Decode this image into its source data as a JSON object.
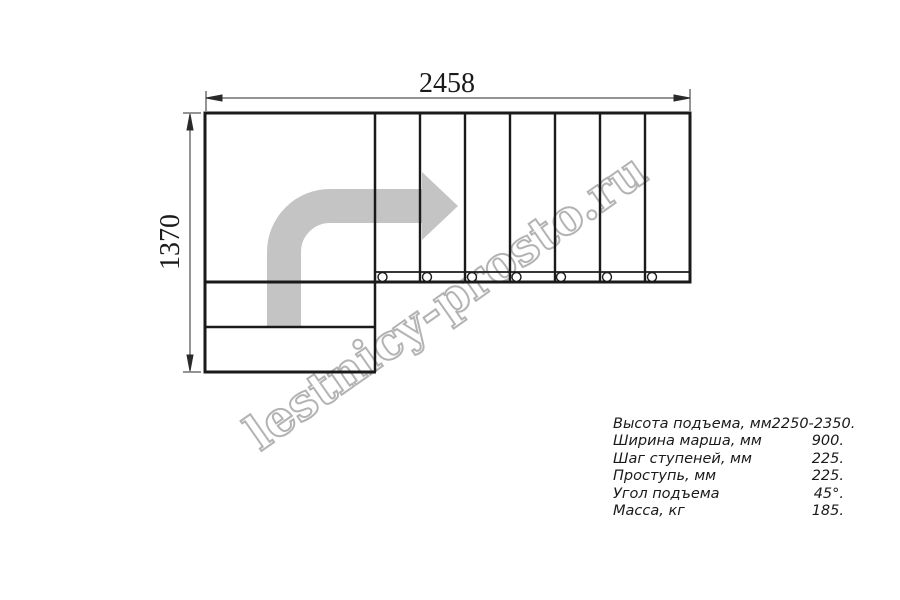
{
  "diagram": {
    "top_dimension_label": "2458",
    "left_dimension_label": "1370",
    "watermark_text": "lestnicy-prosto.ru",
    "colors": {
      "line": "#1a1a1a",
      "dimension_line": "#2a2a2a",
      "direction_arrow": "#c4c4c4",
      "watermark_outline": "#b3b3b3",
      "watermark_fill": "#ffffff"
    }
  },
  "spec_table": {
    "rows": [
      {
        "label": "Высота подъема, мм",
        "value": "2250-2350."
      },
      {
        "label": "Ширина марша, мм",
        "value": "900."
      },
      {
        "label": "Шаг ступеней, мм",
        "value": "225."
      },
      {
        "label": "Проступь, мм",
        "value": "225."
      },
      {
        "label": "Угол подъема",
        "value": "45°."
      },
      {
        "label": "Масса, кг",
        "value": "185."
      }
    ]
  }
}
